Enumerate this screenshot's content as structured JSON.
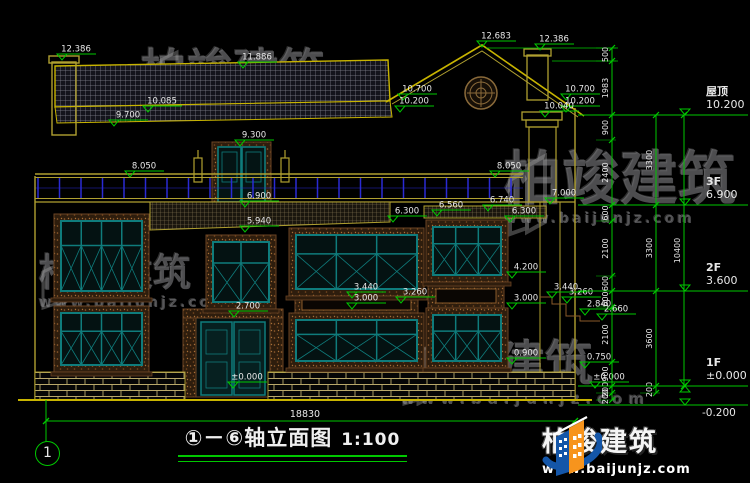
{
  "brand": {
    "name": "柏竣建筑",
    "url": "www.baijunjz.com",
    "blue": "#1456a8",
    "orange": "#f7941d"
  },
  "title": {
    "axes": "①－⑥",
    "name": "轴立面图",
    "scale": "1:100"
  },
  "axis_bubble": "1",
  "dims": {
    "total_width": "18830"
  },
  "colors": {
    "background": "#000000",
    "wall_yellow": "#b0a030",
    "roof_yellow": "#c8b400",
    "dim_green": "#00c800",
    "frame_teal": "#0f7c7c",
    "railing_blue": "#2a2ad4",
    "trim_brown": "#6b4423",
    "text_white": "#e8e8e8"
  },
  "floors": [
    {
      "name": "屋顶",
      "elev": "10.200",
      "y": 115
    },
    {
      "name": "3F",
      "elev": "6.900",
      "y": 205
    },
    {
      "name": "2F",
      "elev": "3.600",
      "y": 291
    },
    {
      "name": "1F",
      "elev": "±0.000",
      "y": 386
    },
    {
      "name": "",
      "elev": "-0.200",
      "y": 405
    }
  ],
  "markers": [
    [
      62,
      60,
      "12.386"
    ],
    [
      243,
      68,
      "11.886"
    ],
    [
      148,
      112,
      "10.085"
    ],
    [
      114,
      126,
      "9.700"
    ],
    [
      240,
      146,
      "9.300"
    ],
    [
      482,
      47,
      "12.683"
    ],
    [
      540,
      50,
      "12.386"
    ],
    [
      403,
      100,
      "10.700"
    ],
    [
      400,
      112,
      "10.200"
    ],
    [
      566,
      100,
      "10.700"
    ],
    [
      566,
      112,
      "10.200"
    ],
    [
      545,
      117,
      "10.040"
    ],
    [
      130,
      177,
      "8.050"
    ],
    [
      495,
      177,
      "8.050"
    ],
    [
      245,
      207,
      "6.900"
    ],
    [
      245,
      232,
      "5.940"
    ],
    [
      437,
      216,
      "6.560"
    ],
    [
      488,
      211,
      "6.740"
    ],
    [
      550,
      204,
      "7.000"
    ],
    [
      393,
      222,
      "6.300"
    ],
    [
      510,
      222,
      "6.300"
    ],
    [
      512,
      278,
      "4.200"
    ],
    [
      352,
      298,
      "3.440"
    ],
    [
      401,
      303,
      "3.260"
    ],
    [
      352,
      309,
      "3.000"
    ],
    [
      512,
      309,
      "3.000"
    ],
    [
      552,
      298,
      "3.440"
    ],
    [
      567,
      303,
      "3.260"
    ],
    [
      585,
      315,
      "2.840"
    ],
    [
      602,
      320,
      "2.660"
    ],
    [
      234,
      317,
      "2.700"
    ],
    [
      512,
      364,
      "0.900"
    ],
    [
      585,
      368,
      "0.750"
    ],
    [
      233,
      388,
      "±0.000"
    ],
    [
      595,
      388,
      "±0.000"
    ]
  ],
  "dim_chains": [
    {
      "x": 612,
      "ticks": [
        48,
        61,
        115,
        140,
        205,
        221,
        276,
        291,
        307,
        362,
        386,
        393,
        400
      ],
      "labels": [
        "500",
        "1983",
        "900",
        "2400",
        "600",
        "2100",
        "600",
        "600",
        "2100",
        "900",
        "200",
        "200"
      ]
    },
    {
      "x": 656,
      "ticks": [
        115,
        205,
        291,
        386,
        393
      ],
      "labels": [
        "3300",
        "3300",
        "3600",
        "200"
      ]
    },
    {
      "x": 684,
      "ticks": [
        115,
        386
      ],
      "labels": [
        "10400"
      ]
    }
  ]
}
